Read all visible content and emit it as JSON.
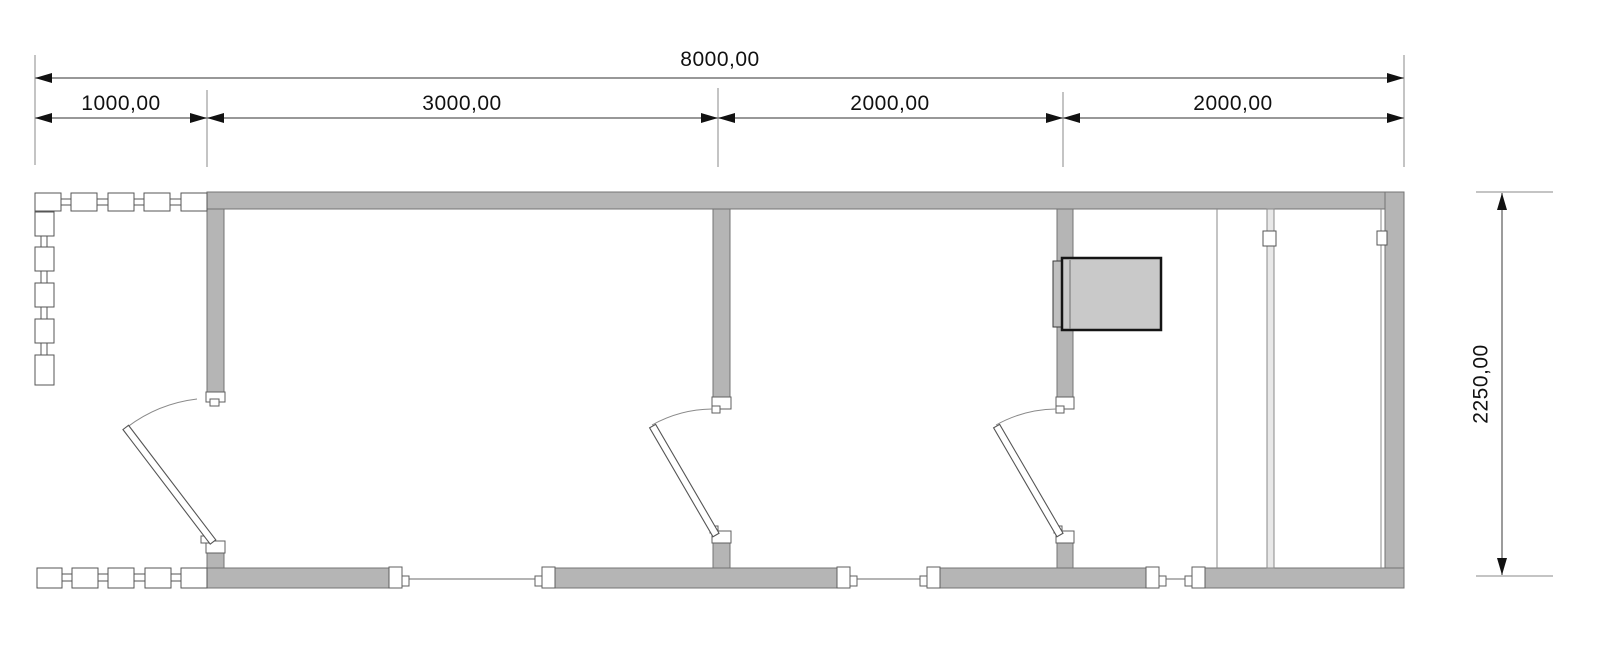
{
  "drawing": {
    "type": "floor-plan",
    "description": "Top-view architectural plan of a rectangular modular building with porch railing, three interior doors, three bottom-wall windows, a wardrobe with sliding panels and a wall-mounted appliance"
  },
  "dimensions": {
    "total": {
      "label": "8000,00",
      "value": 8000
    },
    "segments": [
      {
        "label": "1000,00",
        "value": 1000
      },
      {
        "label": "3000,00",
        "value": 3000
      },
      {
        "label": "2000,00",
        "value": 2000
      },
      {
        "label": "2000,00",
        "value": 2000
      }
    ],
    "height": {
      "label": "2250,00",
      "value": 2250
    }
  },
  "colors": {
    "background": "#ffffff",
    "wall_fill": "#b5b5b5",
    "wall_stroke": "#747474",
    "jamb_fill": "#ffffff",
    "jamb_stroke": "#5f5f5f",
    "thin_line": "#8a8a8a",
    "dim_line": "#5a5a5a",
    "arrow": "#111111",
    "text": "#111111",
    "appliance_fill": "#c9c9c9",
    "appliance_stroke": "#141414",
    "fence_fill": "#ffffff",
    "fence_stroke": "#565656"
  }
}
